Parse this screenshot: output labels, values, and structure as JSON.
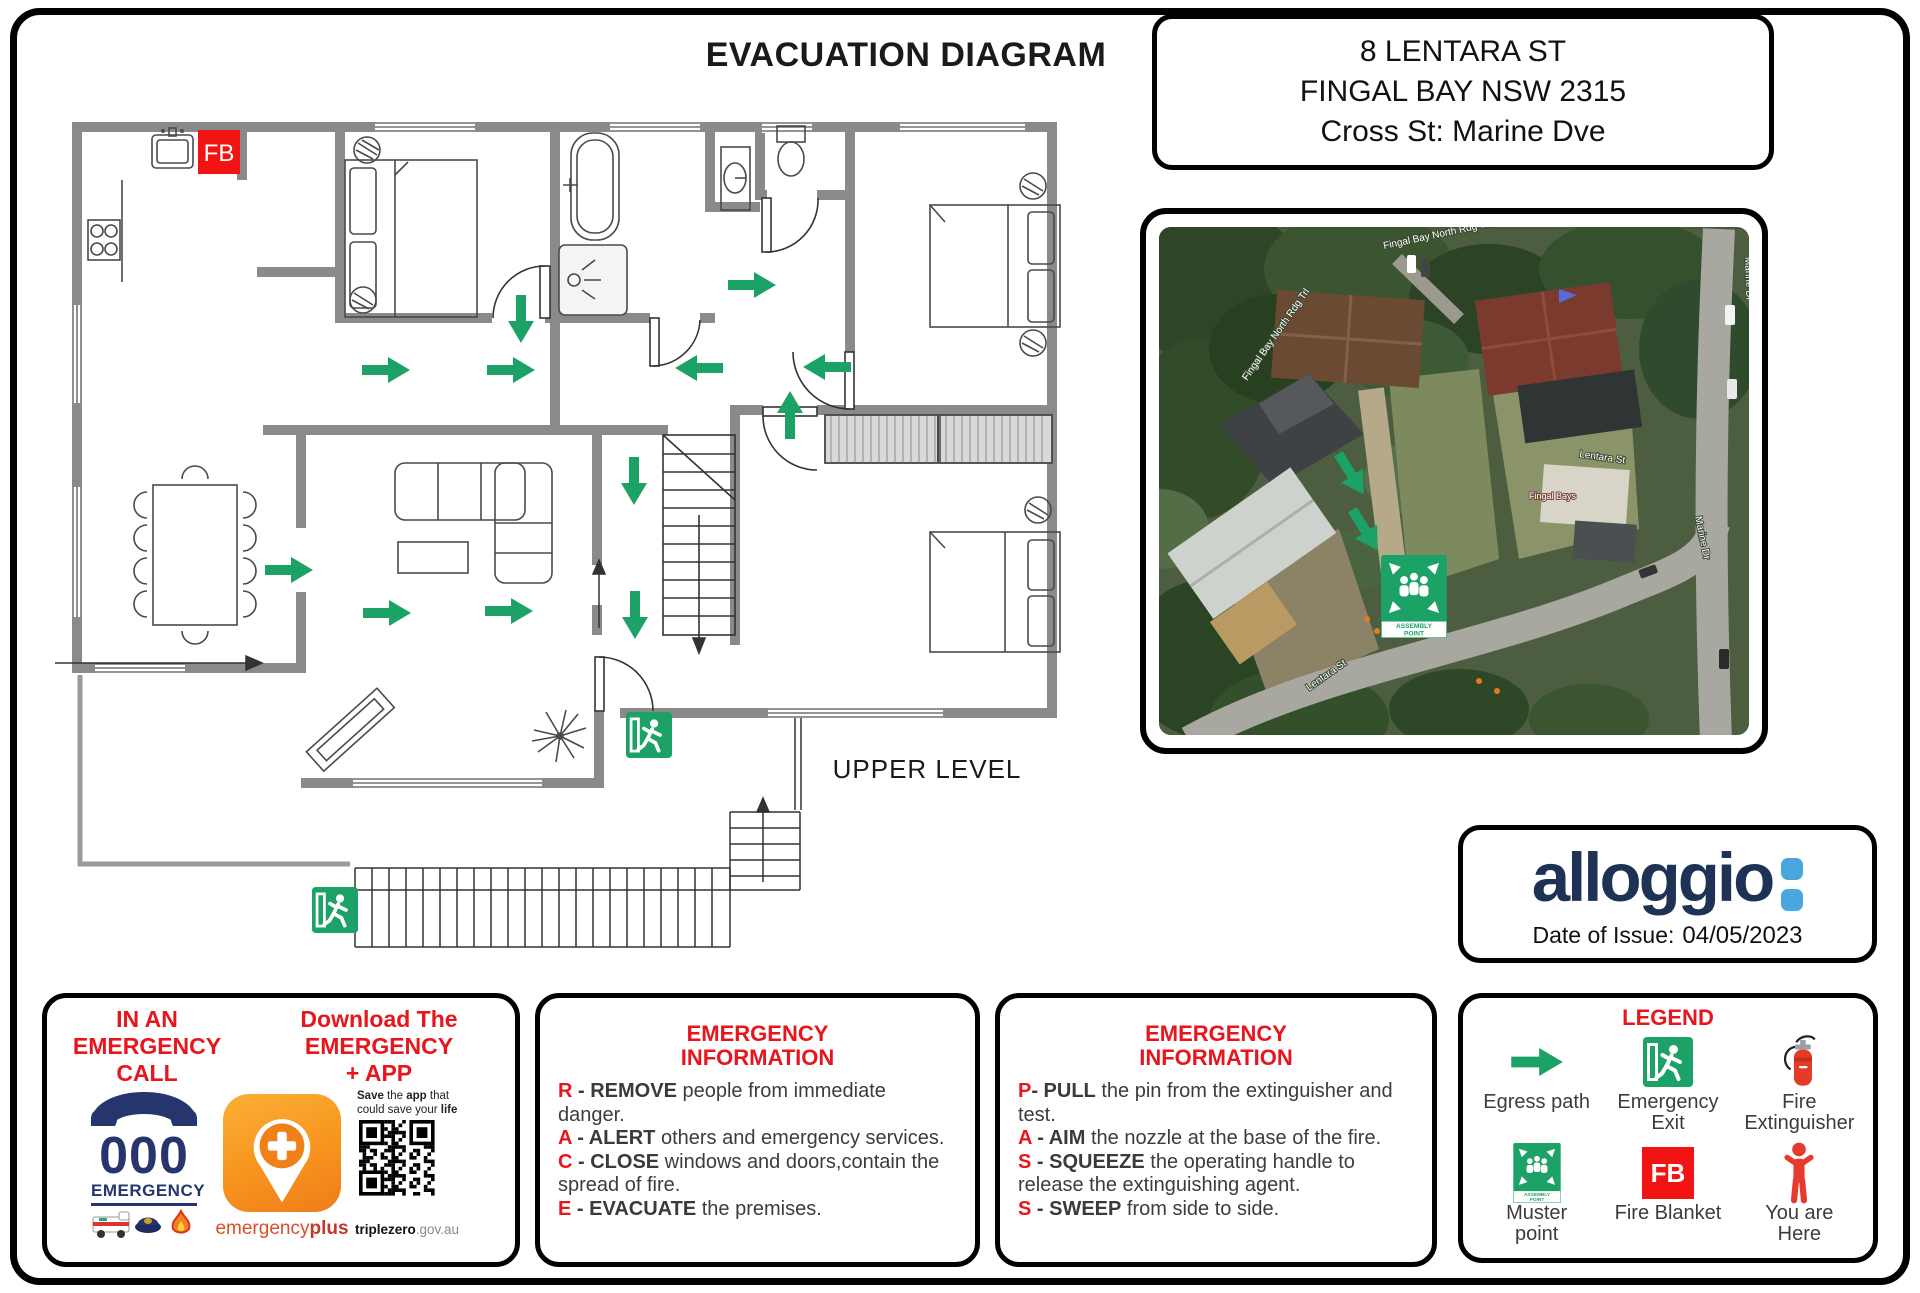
{
  "page": {
    "title": "EVACUATION DIAGRAM"
  },
  "address": {
    "line1": "8 LENTARA ST",
    "line2": "FINGAL BAY NSW 2315",
    "line3": "Cross St: Marine Dve"
  },
  "floor_plan": {
    "level_label": "UPPER LEVEL",
    "fire_blanket_label": "FB"
  },
  "map": {
    "labels": {
      "trail": "Fingal Bay North Rdg Trl",
      "marine": "Marine Dr",
      "lentara": "Lentara St",
      "poi": "Fingal Bays"
    },
    "assembly": {
      "line1": "ASSEMBLY",
      "line2": "POINT"
    }
  },
  "logo": {
    "brand": "alloggio",
    "date_label": "Date of Issue:",
    "date_value": "04/05/2023"
  },
  "emergency_call": {
    "heading_lines": [
      "IN AN",
      "EMERGENCY",
      "CALL"
    ],
    "download_lines": [
      "Download The",
      "EMERGENCY",
      "+ APP"
    ],
    "number": "000",
    "number_caption": "EMERGENCY",
    "app_regular": "emergency",
    "app_bold": "plus",
    "save_parts": [
      {
        "t": "Save",
        "b": true
      },
      {
        "t": " the ",
        "b": false
      },
      {
        "t": "app",
        "b": true
      },
      {
        "t": " that",
        "b": false
      },
      {
        "t": "could save your ",
        "b": false,
        "nl": true
      },
      {
        "t": "life",
        "b": true
      }
    ],
    "site_bold": "triplezero",
    "site_rest": ".gov.au"
  },
  "race": {
    "title_lines": [
      "EMERGENCY",
      "INFORMATION"
    ],
    "items": [
      {
        "letter": "R",
        "sep": " - ",
        "keyword": "REMOVE",
        "rest": " people from immediate danger."
      },
      {
        "letter": "A",
        "sep": " - ",
        "keyword": "ALERT",
        "rest": " others and emergency services."
      },
      {
        "letter": "C",
        "sep": " - ",
        "keyword": "CLOSE",
        "rest": " windows and doors,contain the spread of fire."
      },
      {
        "letter": "E",
        "sep": " - ",
        "keyword": "EVACUATE",
        "rest": " the premises."
      }
    ]
  },
  "pass": {
    "title_lines": [
      "EMERGENCY",
      "INFORMATION"
    ],
    "items": [
      {
        "letter": "P",
        "sep": "- ",
        "keyword": "PULL",
        "rest": " the pin from the extinguisher and test."
      },
      {
        "letter": "A",
        "sep": " - ",
        "keyword": "AIM",
        "rest": " the nozzle at the base of the fire."
      },
      {
        "letter": "S",
        "sep": " - ",
        "keyword": "SQUEEZE",
        "rest": " the operating handle to release the extinguishing agent."
      },
      {
        "letter": "S",
        "sep": " - ",
        "keyword": "SWEEP",
        "rest": " from side to side."
      }
    ]
  },
  "legend": {
    "title": "LEGEND",
    "items": [
      {
        "label": "Egress path",
        "icon": "egress-arrow"
      },
      {
        "label": "Emergency Exit",
        "icon": "emergency-exit"
      },
      {
        "label": "Fire Extinguisher",
        "icon": "fire-extinguisher"
      },
      {
        "label": "Muster point",
        "icon": "muster-point"
      },
      {
        "label": "Fire Blanket",
        "icon": "fire-blanket",
        "badge": "FB"
      },
      {
        "label": "You are Here",
        "icon": "you-are-here"
      }
    ]
  },
  "colors": {
    "accent_green": "#1CA266",
    "accent_red": "#E8151C",
    "brand_navy": "#1D3254",
    "brand_blue": "#4AA7DE",
    "wall_gray": "#8A8A8A",
    "fire_red": "#F21313"
  }
}
